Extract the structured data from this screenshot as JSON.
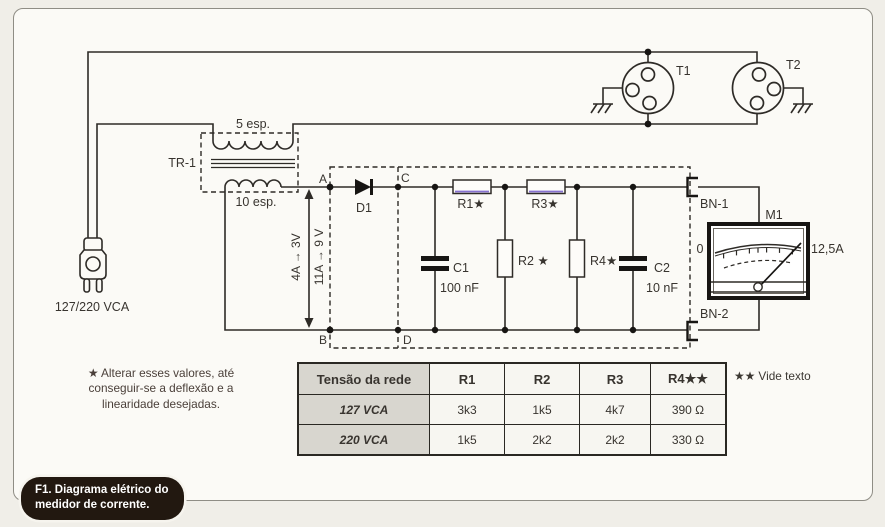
{
  "caption": {
    "line1": "F1. Diagrama elétrico do",
    "line2": "medidor de corrente."
  },
  "labels": {
    "plug_voltage": "127/220 VCA",
    "transformer": "TR-1",
    "primary_turns": "5 esp.",
    "secondary_turns": "10 esp.",
    "node_a": "A",
    "node_b": "B",
    "node_c": "C",
    "node_d": "D",
    "range_left": "4A → 3V",
    "range_right": "11A → 9 V",
    "diode": "D1",
    "c1": "C1",
    "c1_value": "100 nF",
    "c2": "C2",
    "c2_value": "10 nF",
    "r1": "R1★",
    "r2": "R2 ★",
    "r3": "R3★",
    "r4": "R4★",
    "bn1": "BN-1",
    "bn2": "BN-2",
    "meter": "M1",
    "meter_zero": "0",
    "meter_fullscale": "12,5A",
    "t1": "T1",
    "t2": "T2"
  },
  "notes": {
    "adjust_line1": "★ Alterar esses valores,  até",
    "adjust_line2": "conseguir-se a  deflexão e a",
    "adjust_line3": "linearidade desejadas.",
    "vide_texto": "★★ Vide texto"
  },
  "table": {
    "headers": [
      "Tensão da rede",
      "R1",
      "R2",
      "R3",
      "R4★★"
    ],
    "rows": [
      {
        "label": "127 VCA",
        "values": [
          "3k3",
          "1k5",
          "4k7",
          "390 Ω"
        ]
      },
      {
        "label": "220 VCA",
        "values": [
          "1k5",
          "2k2",
          "2k2",
          "330 Ω"
        ]
      }
    ]
  },
  "colors": {
    "wire": "#2e2b27",
    "resistor_print_accent": "#6a4fc8",
    "caption_bg": "#221810"
  }
}
